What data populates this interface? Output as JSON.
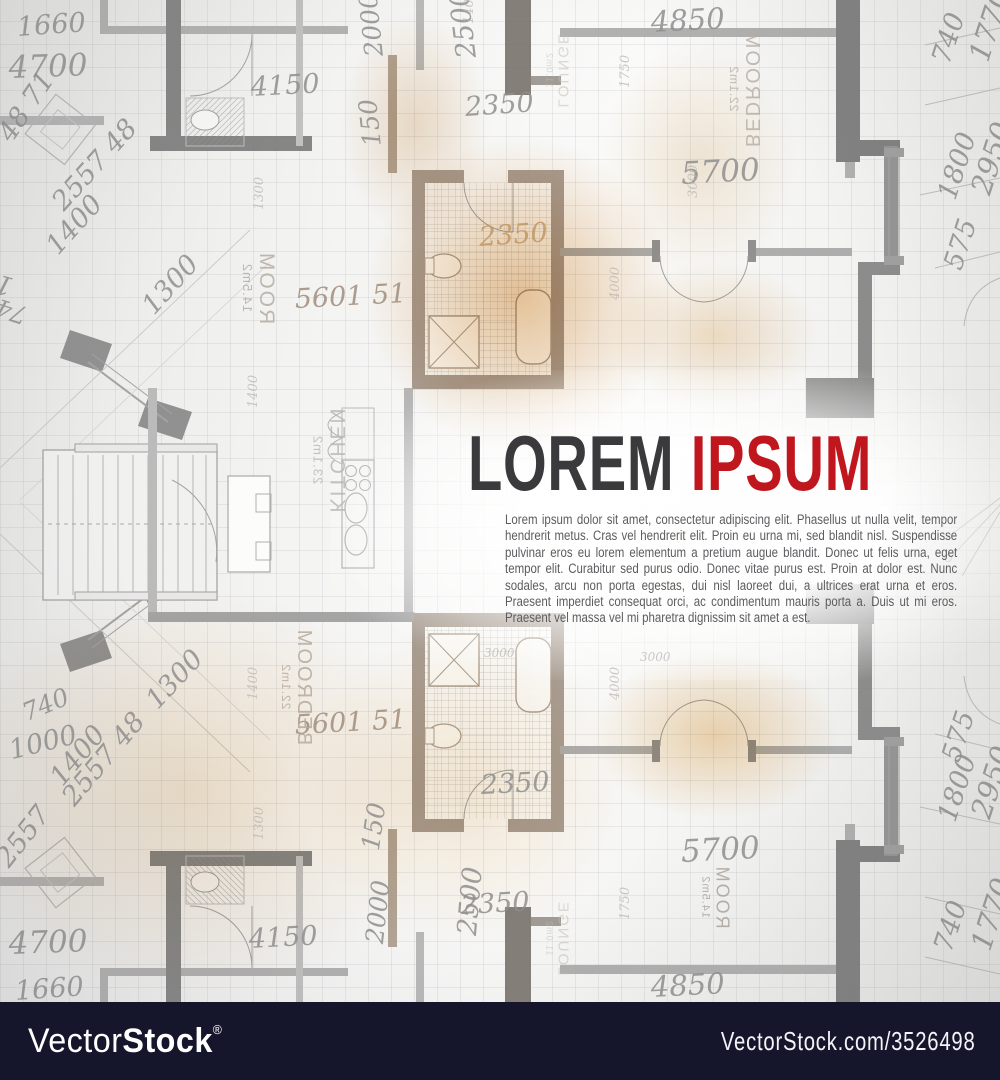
{
  "title": {
    "word1": "LOREM",
    "word2": "IPSUM",
    "word1_color": "#3a3a3c",
    "word2_color": "#c0161d"
  },
  "paragraph": "Lorem ipsum dolor sit amet, consectetur adipiscing elit. Phasellus ut nulla velit, tempor hendrerit metus. Cras vel hendrerit elit. Proin eu urna mi, sed blandit nisl. Suspendisse pulvinar eros eu lorem elementum a pretium augue blandit. Donec ut felis urna, eget tempor elit. Curabitur sed purus odio. Donec vitae purus est. Proin at dolor est. Nunc sodales, arcu non porta egestas, dui nisl laoreet dui, a ultrices erat urna et eros. Praesent imperdiet consequat orci, ac condimentum mauris porta a. Duis ut mi eros. Praesent vel massa vel mi pharetra dignissim sit amet a est.",
  "watermark": {
    "bar_color": "#15152b",
    "logo_light": "Vector",
    "logo_bold": "Stock",
    "registered": "®",
    "site_text": "VectorStock.com/3526498"
  },
  "blueprint": {
    "line_color": "#9d9d9d",
    "dark_wall_color": "#7a7a7a",
    "glow_color": "#d69a54",
    "dimension_labels": [
      {
        "t": "1660",
        "x": 16,
        "y": 12,
        "r": -4,
        "s": 27
      },
      {
        "t": "4700",
        "x": 8,
        "y": 50,
        "r": -2,
        "s": 31
      },
      {
        "t": "48 71",
        "x": -8,
        "y": 130,
        "r": -56,
        "s": 27
      },
      {
        "t": "2557 48",
        "x": 46,
        "y": 196,
        "r": -48,
        "s": 27
      },
      {
        "t": "1400",
        "x": 40,
        "y": 240,
        "r": -48,
        "s": 27
      },
      {
        "t": "1000",
        "x": 8,
        "y": 302,
        "r": 196,
        "s": 27
      },
      {
        "t": "740",
        "x": 22,
        "y": 330,
        "r": 198,
        "s": 25
      },
      {
        "t": "1300",
        "x": 136,
        "y": 300,
        "r": -48,
        "s": 27
      },
      {
        "t": "4150",
        "x": 250,
        "y": 72,
        "r": -3,
        "s": 27
      },
      {
        "t": "2000",
        "x": 360,
        "y": 58,
        "r": -96,
        "s": 25
      },
      {
        "t": "150",
        "x": 358,
        "y": 148,
        "r": -96,
        "s": 25
      },
      {
        "t": "2500",
        "x": 452,
        "y": 60,
        "r": -97,
        "s": 27
      },
      {
        "t": "2350",
        "x": 464,
        "y": 92,
        "r": -4,
        "s": 27
      },
      {
        "t": "2350",
        "x": 478,
        "y": 222,
        "r": -4,
        "s": 27,
        "c": "#c59a67",
        "o": 0.9
      },
      {
        "t": "5601 51",
        "x": 294,
        "y": 284,
        "r": -3,
        "s": 27,
        "c": "#a18d7c"
      },
      {
        "t": "4850",
        "x": 650,
        "y": 5,
        "r": -3,
        "s": 29
      },
      {
        "t": "5700",
        "x": 680,
        "y": 156,
        "r": -3,
        "s": 31
      },
      {
        "t": "740",
        "x": 926,
        "y": 58,
        "r": -72,
        "s": 27
      },
      {
        "t": "1770",
        "x": 962,
        "y": 55,
        "r": -72,
        "s": 29
      },
      {
        "t": "1800",
        "x": 932,
        "y": 194,
        "r": -72,
        "s": 27
      },
      {
        "t": "2950",
        "x": 964,
        "y": 188,
        "r": -72,
        "s": 29
      },
      {
        "t": "575",
        "x": 938,
        "y": 264,
        "r": -72,
        "s": 27
      },
      {
        "t": "1400",
        "x": 462,
        "y": 24,
        "r": -90,
        "s": 13,
        "c": "#b8b4ae",
        "o": 0.7
      },
      {
        "t": "1300",
        "x": 252,
        "y": 210,
        "r": -90,
        "s": 13,
        "c": "#b8b4ae",
        "o": 0.7
      },
      {
        "t": "1750",
        "x": 618,
        "y": 88,
        "r": -90,
        "s": 13,
        "c": "#b8b4ae",
        "o": 0.7
      },
      {
        "t": "3000",
        "x": 686,
        "y": 198,
        "r": -90,
        "s": 13,
        "c": "#b8b4ae",
        "o": 0.7
      },
      {
        "t": "4000",
        "x": 608,
        "y": 300,
        "r": -90,
        "s": 13,
        "c": "#b8b4ae",
        "o": 0.7
      },
      {
        "t": "1400",
        "x": 246,
        "y": 408,
        "r": -90,
        "s": 13,
        "c": "#b8b4ae",
        "o": 0.7
      },
      {
        "t": "4700",
        "x": 8,
        "y": 926,
        "r": -2,
        "s": 31
      },
      {
        "t": "1660",
        "x": 14,
        "y": 976,
        "r": -4,
        "s": 27
      },
      {
        "t": "4150",
        "x": 248,
        "y": 924,
        "r": -3,
        "s": 27
      },
      {
        "t": "2000",
        "x": 360,
        "y": 942,
        "r": -84,
        "s": 25
      },
      {
        "t": "2500",
        "x": 452,
        "y": 934,
        "r": -85,
        "s": 27
      },
      {
        "t": "2350",
        "x": 460,
        "y": 890,
        "r": -3,
        "s": 27
      },
      {
        "t": "150",
        "x": 356,
        "y": 848,
        "r": -82,
        "s": 25
      },
      {
        "t": "5700",
        "x": 680,
        "y": 834,
        "r": -3,
        "s": 31
      },
      {
        "t": "4850",
        "x": 650,
        "y": 970,
        "r": -3,
        "s": 29
      },
      {
        "t": "2350",
        "x": 480,
        "y": 770,
        "r": -3,
        "s": 27
      },
      {
        "t": "5601 51",
        "x": 294,
        "y": 710,
        "r": -3,
        "s": 27,
        "c": "#a18d7c"
      },
      {
        "t": "1300",
        "x": 140,
        "y": 694,
        "r": -47,
        "s": 27
      },
      {
        "t": "740",
        "x": 18,
        "y": 700,
        "r": -22,
        "s": 25
      },
      {
        "t": "1000",
        "x": 6,
        "y": 736,
        "r": -14,
        "s": 27
      },
      {
        "t": "1400",
        "x": 44,
        "y": 772,
        "r": -50,
        "s": 27
      },
      {
        "t": "2557 48",
        "x": 56,
        "y": 792,
        "r": -50,
        "s": 27
      },
      {
        "t": "2557",
        "x": -10,
        "y": 854,
        "r": -52,
        "s": 27
      },
      {
        "t": "575",
        "x": 936,
        "y": 756,
        "r": -72,
        "s": 27
      },
      {
        "t": "1800",
        "x": 932,
        "y": 816,
        "r": -72,
        "s": 27
      },
      {
        "t": "2950",
        "x": 964,
        "y": 812,
        "r": -72,
        "s": 29
      },
      {
        "t": "740",
        "x": 928,
        "y": 946,
        "r": -72,
        "s": 27
      },
      {
        "t": "1770",
        "x": 964,
        "y": 944,
        "r": -72,
        "s": 29
      },
      {
        "t": "3000",
        "x": 484,
        "y": 646,
        "r": 0,
        "s": 12,
        "c": "#b8b4ae",
        "o": 0.7
      },
      {
        "t": "3000",
        "x": 640,
        "y": 650,
        "r": 0,
        "s": 12,
        "c": "#b8b4ae",
        "o": 0.7
      },
      {
        "t": "1400",
        "x": 246,
        "y": 700,
        "r": -90,
        "s": 13,
        "c": "#b8b4ae",
        "o": 0.7
      },
      {
        "t": "1300",
        "x": 252,
        "y": 840,
        "r": -90,
        "s": 13,
        "c": "#b8b4ae",
        "o": 0.7
      },
      {
        "t": "4000",
        "x": 608,
        "y": 700,
        "r": -90,
        "s": 13,
        "c": "#b8b4ae",
        "o": 0.7
      },
      {
        "t": "1750",
        "x": 618,
        "y": 920,
        "r": -90,
        "s": 13,
        "c": "#b8b4ae",
        "o": 0.7
      }
    ],
    "room_labels": [
      {
        "name": "ROOM",
        "area": "14.5m2",
        "x": 222,
        "y": 268,
        "s": 21,
        "c": "#b2a99d",
        "o": 0.8
      },
      {
        "name": "KITCHEN",
        "area": "23.1m2",
        "x": 276,
        "y": 440,
        "s": 21,
        "c": "#b6b6b4",
        "o": 0.8
      },
      {
        "name": "BEDROOM",
        "area": "22.1m2",
        "x": 686,
        "y": 70,
        "s": 20,
        "c": "#b5aea6",
        "o": 0.8
      },
      {
        "name": "LOUNGE",
        "area": "11.0m2",
        "x": 520,
        "y": 56,
        "s": 15,
        "c": "#c4beb6",
        "o": 0.55
      },
      {
        "name": "BEDROOM",
        "area": "22.1m2",
        "x": 238,
        "y": 668,
        "s": 20,
        "c": "#b3a698",
        "o": 0.8
      },
      {
        "name": "ROOM",
        "area": "14.5m2",
        "x": 684,
        "y": 880,
        "s": 18,
        "c": "#a8a097",
        "o": 0.8
      },
      {
        "name": "LOUNGE",
        "area": "11.0m2",
        "x": 520,
        "y": 924,
        "s": 15,
        "c": "#c4beb6",
        "o": 0.55
      }
    ]
  }
}
